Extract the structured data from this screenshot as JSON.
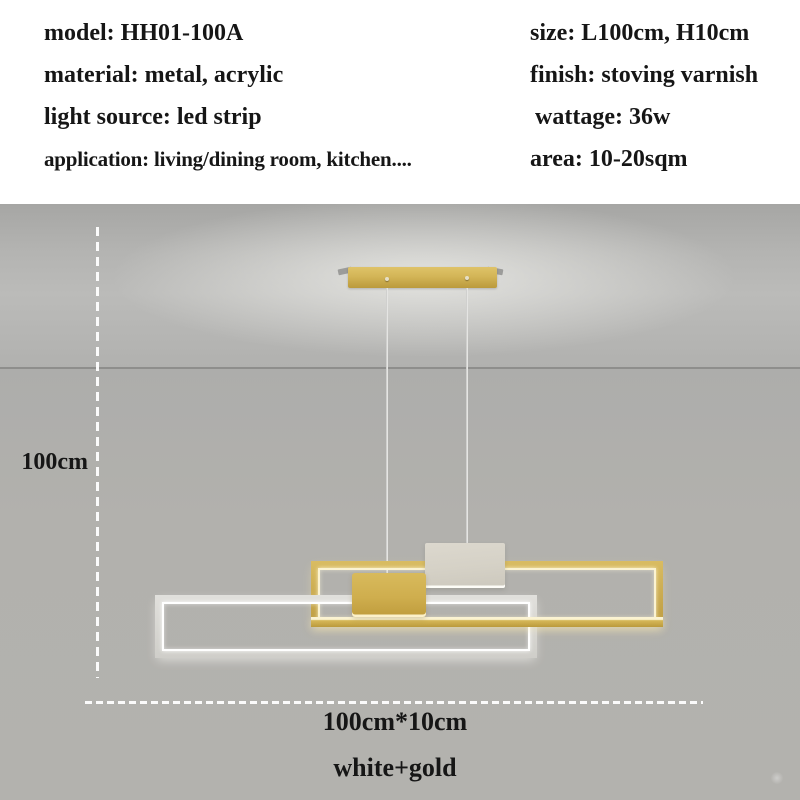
{
  "specs": {
    "left": [
      "model: HH01-100A",
      "material: metal, acrylic",
      "light source: led strip",
      "application: living/dining room, kitchen...."
    ],
    "right": [
      "size: L100cm, H10cm",
      "finish: stoving varnish",
      "wattage: 36w",
      "area: 10-20sqm"
    ]
  },
  "dimensions": {
    "drop_height": "100cm",
    "fixture_size": "100cm*10cm"
  },
  "variant": "white+gold",
  "colors": {
    "gold": "#c9a84c",
    "gold_light": "#dfc369",
    "gold_dark": "#bb9a3c",
    "white_frame": "#dad8d4",
    "led_warm": "#fbf3d2",
    "led_white": "#ffffff",
    "wall_gray": "#b2b1ad",
    "text": "#161616"
  }
}
